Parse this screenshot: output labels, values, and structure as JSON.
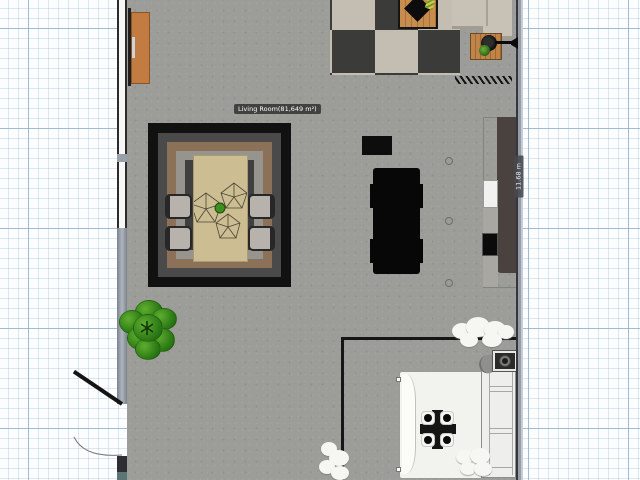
{
  "editor": {
    "room_label": "Living Room(81,649 m²)",
    "wall_dimension": "11.68 m"
  },
  "colors": {
    "floor": "#9c9c98",
    "grid_paper": "#fcfdff",
    "grid_line": "#7896b4",
    "tile_dark": "#3b3b39",
    "tile_light": "#c4beb2",
    "rug_outer_black": "#111111",
    "rug_brown": "#8b7158",
    "dining_table_wood": "#ccbd93",
    "plant_green": "#2f7d17",
    "side_table_wood": "#c08448",
    "sideboard_orange": "#c27b40",
    "sofa_beige": "#c8c2b6",
    "island_black": "#070707",
    "bed_white": "#f2f2ef",
    "wall_steel": "#969da6",
    "wardrobe_brown": "#4a423e"
  },
  "objects": [
    {
      "name": "window"
    },
    {
      "name": "door"
    },
    {
      "name": "sideboard"
    },
    {
      "name": "kitchen-tile-floor"
    },
    {
      "name": "cutting-board"
    },
    {
      "name": "sofa"
    },
    {
      "name": "wooden-side-table"
    },
    {
      "name": "frying-pan"
    },
    {
      "name": "hatch-marker"
    },
    {
      "name": "area-rug"
    },
    {
      "name": "dining-table"
    },
    {
      "name": "dining-chair"
    },
    {
      "name": "bush-plant"
    },
    {
      "name": "black-console"
    },
    {
      "name": "black-island"
    },
    {
      "name": "wardrobe"
    },
    {
      "name": "cabinet"
    },
    {
      "name": "partition-wall"
    },
    {
      "name": "bed"
    },
    {
      "name": "bed-tray"
    },
    {
      "name": "headboard-shelf"
    },
    {
      "name": "wall-lamp"
    },
    {
      "name": "stool"
    },
    {
      "name": "cloud-decor"
    }
  ]
}
